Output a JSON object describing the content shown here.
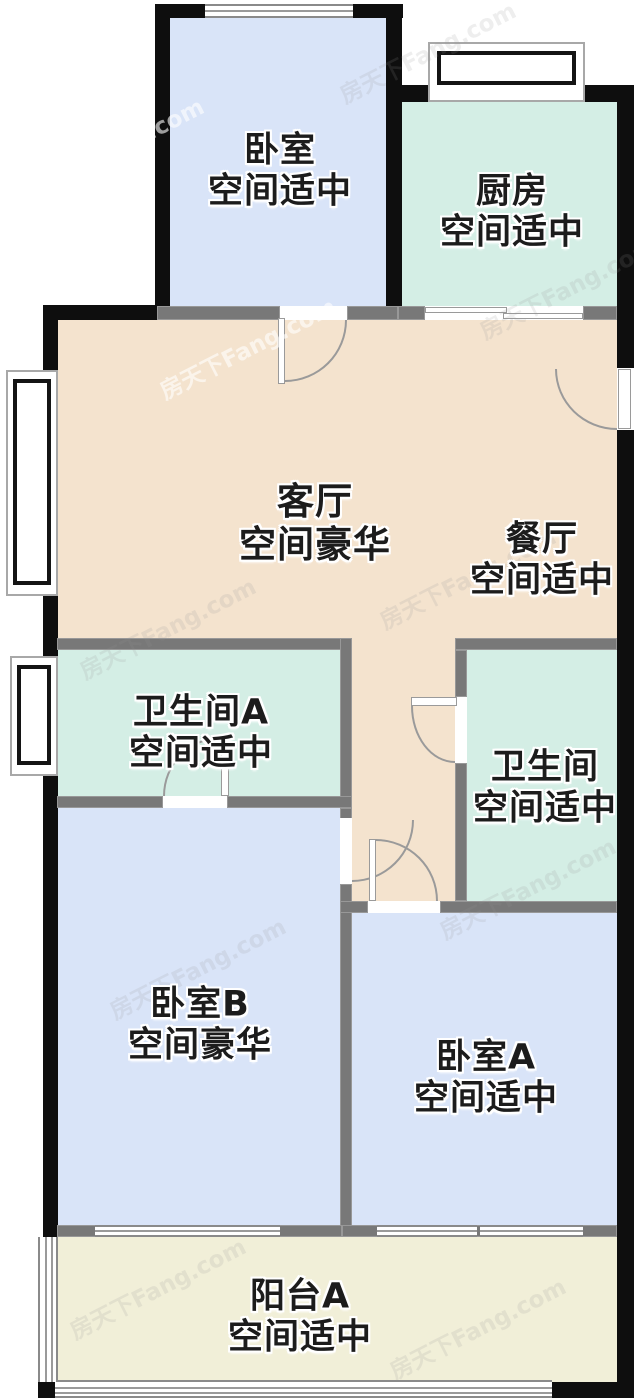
{
  "watermark": {
    "text": "房天下Fang.com"
  },
  "rooms": [
    {
      "id": "bedroom",
      "name": "卧室",
      "status": "空间适中"
    },
    {
      "id": "kitchen",
      "name": "厨房",
      "status": "空间适中"
    },
    {
      "id": "living-room",
      "name": "客厅",
      "status": "空间豪华"
    },
    {
      "id": "dining-room",
      "name": "餐厅",
      "status": "空间适中"
    },
    {
      "id": "bathroom-a",
      "name": "卫生间A",
      "status": "空间适中"
    },
    {
      "id": "bathroom",
      "name": "卫生间",
      "status": "空间适中"
    },
    {
      "id": "bedroom-b",
      "name": "卧室B",
      "status": "空间豪华"
    },
    {
      "id": "bedroom-a",
      "name": "卧室A",
      "status": "空间适中"
    },
    {
      "id": "balcony-a",
      "name": "阳台A",
      "status": "空间适中"
    }
  ],
  "colors": {
    "bedroom_fill": "#d9e4f8",
    "kitchen_bath_fill": "#d4eee5",
    "living_fill": "#f4e3ce",
    "balcony_fill": "#f1efd8",
    "exterior_wall": "#0e0e0e",
    "interior_wall": "#787878"
  }
}
